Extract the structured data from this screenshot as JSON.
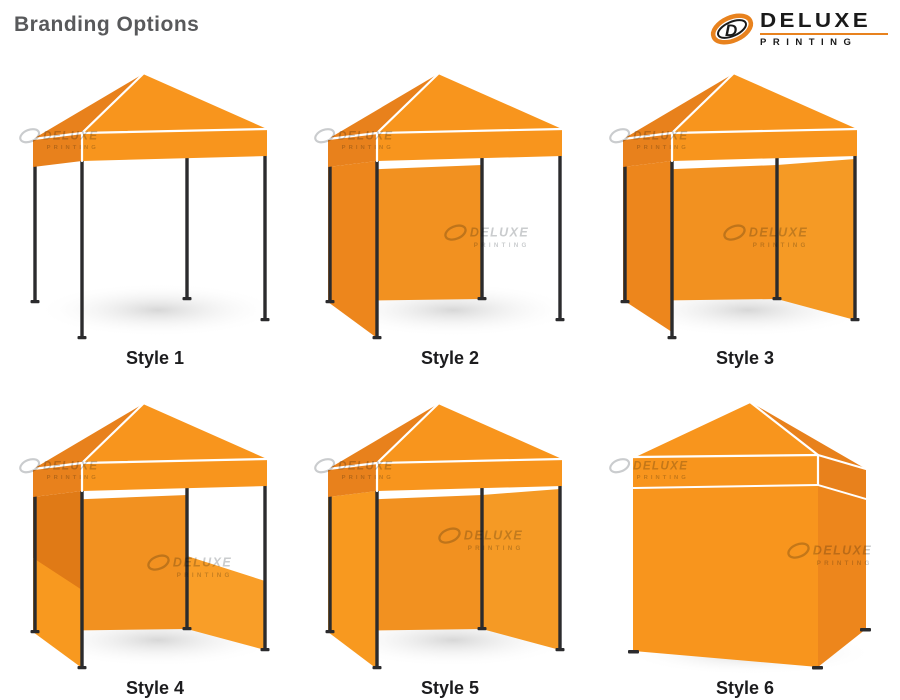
{
  "title": "Branding Options",
  "logo": {
    "name": "DELUXE",
    "subtitle": "PRINTING"
  },
  "watermark": {
    "line1": "DELUXE",
    "line2": "PRINTING"
  },
  "styles": [
    {
      "label": "Style 1",
      "walls": "canopy only, open frame"
    },
    {
      "label": "Style 2",
      "walls": "canopy with back wall and left side wall"
    },
    {
      "label": "Style 3",
      "walls": "canopy with back and both side walls, open front"
    },
    {
      "label": "Style 4",
      "walls": "canopy with back wall, full left wall and right half wall"
    },
    {
      "label": "Style 5",
      "walls": "canopy fully walled except open front"
    },
    {
      "label": "Style 6",
      "walls": "fully enclosed canopy"
    }
  ],
  "colors": {
    "background": "#FFFFFF",
    "canopy_front": "#F8951D",
    "canopy_side": "#E8811C",
    "wall_back": "#F29120",
    "wall_left": "#ED861C",
    "wall_left_bright": "#F8991F",
    "wall_right": "#F59A25",
    "half_wall": "#F99E28",
    "wall_dark": "#E07A16",
    "leg": "#2B2B2D",
    "shadow": "#D7D7D7",
    "title_text": "#58595B",
    "label_text": "#1C1C1E",
    "logo_orange": "#E8821E",
    "logo_black": "#1A1A1A",
    "watermark_gray": "#C4C7C9"
  }
}
